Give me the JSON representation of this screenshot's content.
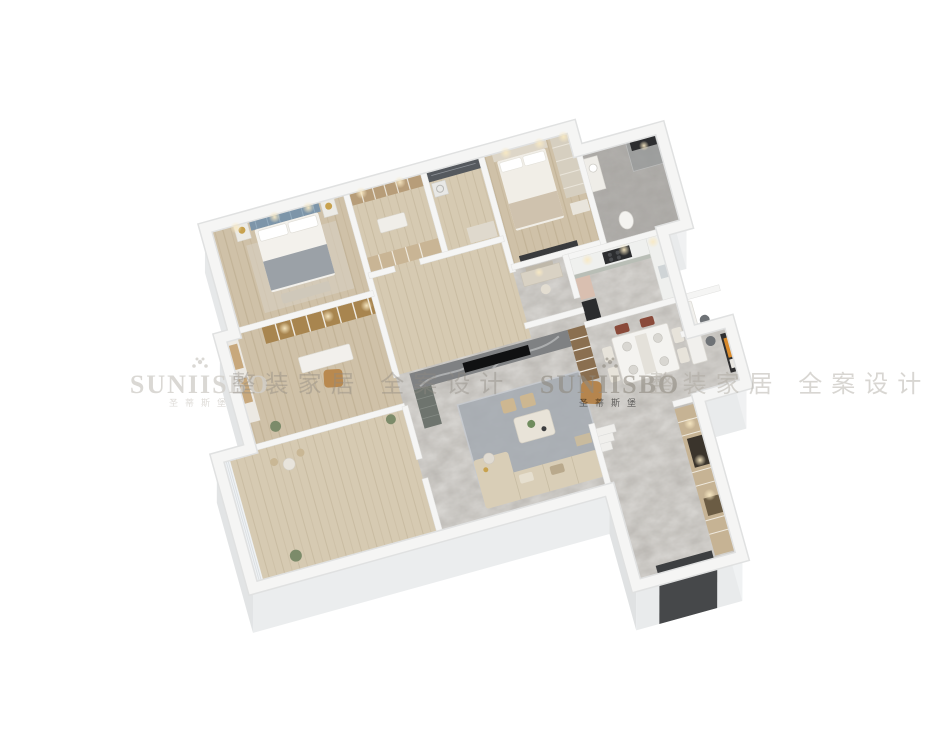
{
  "scene": {
    "description": "3D isometric dollhouse rendering of an apartment floor plan on a white background",
    "background": "#ffffff"
  },
  "watermark": {
    "icon": "floral-crown",
    "brand": "SUNIISBO",
    "brand_cn": "圣蒂斯堡",
    "tagline": "整装家居全案设计",
    "tagline_spaced": "整装家居 全案设计",
    "repeat_count": 2,
    "color_light": "#cfccc6",
    "color_dark": "#8e8densed"
  },
  "palette": {
    "wall_top": "#f4f4f3",
    "wall_face_south": "#e9ebec",
    "wall_face_west": "#e2e4e5",
    "wall_face_east": "#f0f1f2",
    "marble_floor": "#b9b6b1",
    "wood_floor": "#cfc1a8",
    "dark_feature_wall": "#55595e",
    "tv_marble": "#7f8183",
    "sofa": "#d9ceb7",
    "armchair": "#b5854e",
    "rug": "#a5abb2",
    "entry_cabinet": "#c6b394",
    "kitchen_cabinet": "#b9beb6",
    "bed_headboard": "#7d95a9",
    "art_accent": "#d98a2b",
    "door_mat": "#3d3f41"
  }
}
